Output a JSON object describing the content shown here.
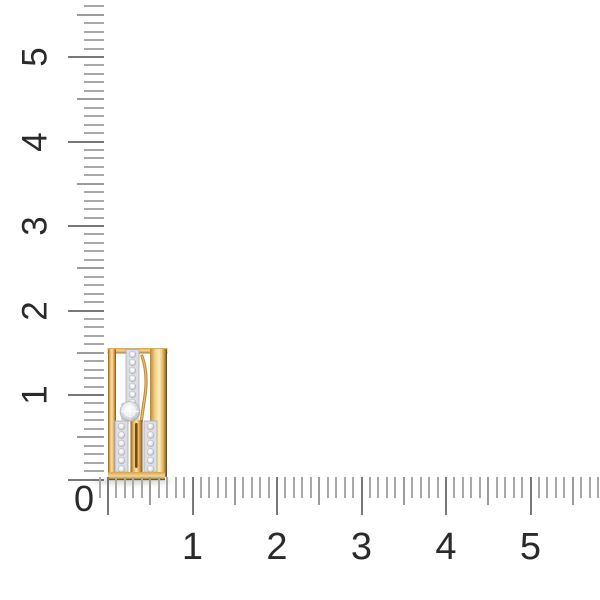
{
  "page": {
    "background": "#ffffff",
    "description_label": "gold earring with diamonds on measurement grid"
  },
  "rulers": {
    "unit_px": 84.5,
    "minor_per_unit": 10,
    "tick_color": "#a8a8a8",
    "mid_tick_color": "#9b9b9b",
    "major_tick_color": "#787878",
    "number_color": "#2a2a2a",
    "origin_label": "0",
    "origin_pos": {
      "x": 84,
      "y": 499
    },
    "origin_font_px": 36,
    "left": {
      "labels": [
        "1",
        "2",
        "3",
        "4",
        "5"
      ],
      "edge_x": 104,
      "origin_y": 479.5,
      "minor_len": 20,
      "mid_len": 27,
      "major_len": 36,
      "ticks_to_unit": 5.6,
      "label_x": 35,
      "font_px": 35
    },
    "bottom": {
      "labels": [
        "1",
        "2",
        "3",
        "4",
        "5"
      ],
      "edge_y": 476.5,
      "origin_x": 108,
      "minor_len": 21,
      "mid_len": 28,
      "major_len": 38,
      "ticks_from_unit": -0.1,
      "ticks_to_unit": 5.8,
      "label_y": 547,
      "font_px": 38
    }
  },
  "product": {
    "name": "gold-diamond-earring",
    "gold_color": "#e2a94f",
    "gold_dark_color": "#7c5414",
    "diamond_color": "#e9eaee",
    "position": {
      "x": 107,
      "y": 348,
      "width": 61,
      "height": 133
    },
    "shadow": {
      "x": 92,
      "y": 479,
      "width": 80,
      "height": 5
    }
  }
}
